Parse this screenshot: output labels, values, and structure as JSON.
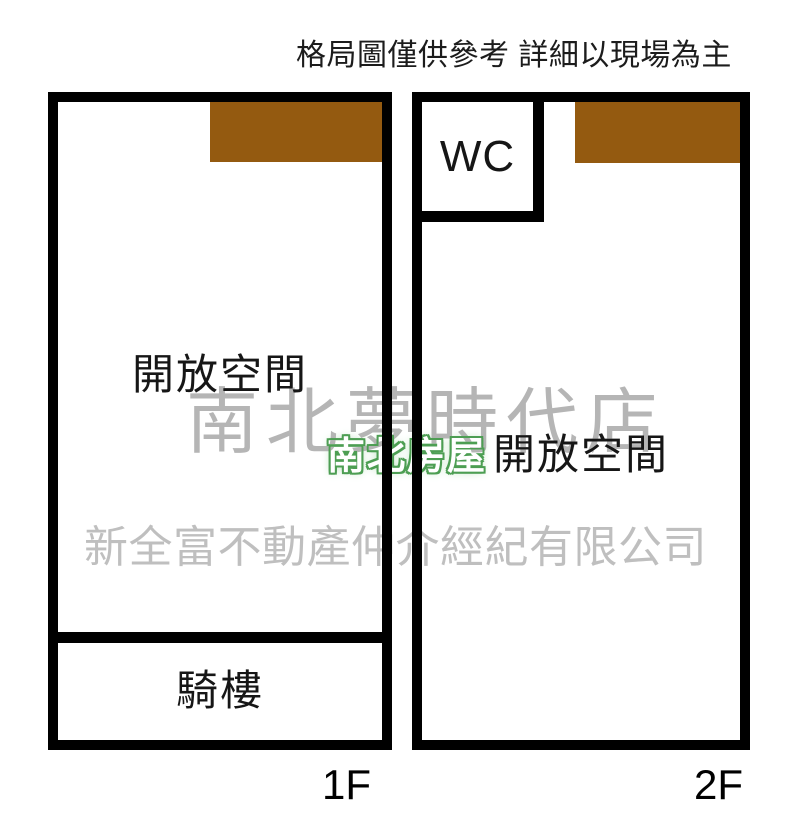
{
  "disclaimer": "格局圖僅供參考 詳細以現場為主",
  "floors": {
    "f1": {
      "label": "1F",
      "rooms": {
        "open_space": "開放空間",
        "arcade": "騎樓"
      }
    },
    "f2": {
      "label": "2F",
      "rooms": {
        "open_space": "開放空間",
        "wc": "WC"
      }
    }
  },
  "watermarks": {
    "store": "南北夢時代店",
    "badge": "南北房屋",
    "company": "新全富不動產仲介經紀有限公司"
  },
  "colors": {
    "wall": "#000000",
    "canopy_brown": "#945a10",
    "watermark_gray": "#a3a3a3",
    "badge_green": "#4d9e53"
  }
}
